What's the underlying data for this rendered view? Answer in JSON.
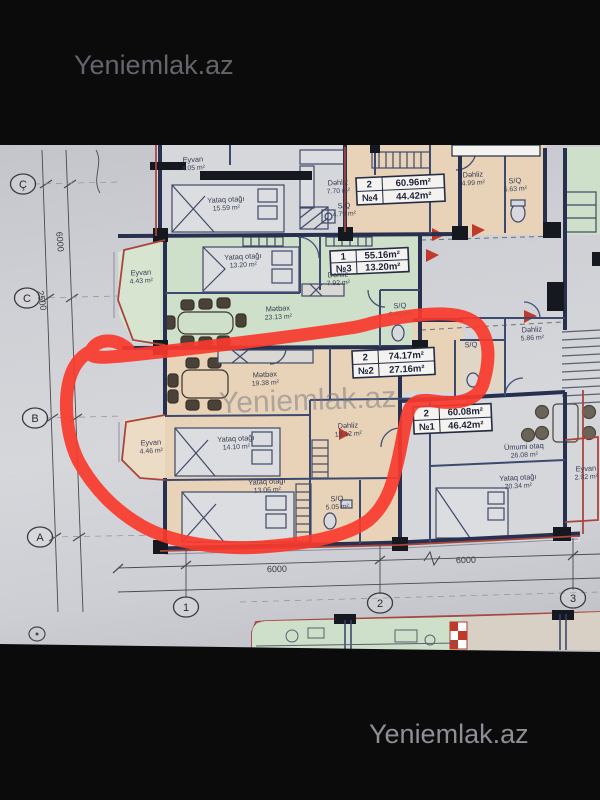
{
  "watermarks": {
    "top": "Yeniemlak.az",
    "middle": "Yeniemlak.az",
    "bottom": "Yeniemlak.az"
  },
  "colors": {
    "marker_red": "#f83a2c",
    "paper": "#d2d3d8",
    "green_unit": "#cfe0ca",
    "green_balcony": "#d6e4d0",
    "tan_unit": "#e8d3b9",
    "tan_balcony": "#ecdbc5",
    "white_unit": "#d6d7db",
    "wall_dark": "#27304e",
    "wall_red": "#a8463e",
    "table_bg": "#f4f3f0",
    "ink": "#353c52"
  },
  "plan": {
    "room_labels": [
      {
        "name": "Eyvan",
        "area": "4.05 m²",
        "x": 193,
        "y": 162
      },
      {
        "name": "Yataq otağı",
        "area": "15.59 m²",
        "x": 226,
        "y": 202
      },
      {
        "name": "Dəhliz",
        "area": "7.70 m²",
        "x": 338,
        "y": 185
      },
      {
        "name": "S/Q",
        "area": "4.79 m²",
        "x": 344,
        "y": 208
      },
      {
        "name": "Dəhliz",
        "area": "4.99 m²",
        "x": 473,
        "y": 177
      },
      {
        "name": "S/Q",
        "area": "5.63 m²",
        "x": 515,
        "y": 183
      },
      {
        "name": "Eyvan",
        "area": "4.43 m²",
        "x": 141,
        "y": 275
      },
      {
        "name": "Yataq otağı",
        "area": "13.20 m²",
        "x": 243,
        "y": 259
      },
      {
        "name": "Dəhliz",
        "area": "7.92 m²",
        "x": 338,
        "y": 277
      },
      {
        "name": "Mətbəx",
        "area": "23.13 m²",
        "x": 278,
        "y": 311
      },
      {
        "name": "S/Q",
        "area": "6.48 m²",
        "x": 400,
        "y": 308
      },
      {
        "name": "Mətbəx",
        "area": "19.38 m²",
        "x": 265,
        "y": 377
      },
      {
        "name": "Dəhliz",
        "area": "18.12 m²",
        "x": 348,
        "y": 428
      },
      {
        "name": "Eyvan",
        "area": "4.46 m²",
        "x": 151,
        "y": 445
      },
      {
        "name": "Yataq otağı",
        "area": "14.10 m²",
        "x": 236,
        "y": 441
      },
      {
        "name": "Yataq otağı",
        "area": "13.06 m²",
        "x": 267,
        "y": 484
      },
      {
        "name": "S/Q",
        "area": "5.05 m²",
        "x": 337,
        "y": 501
      },
      {
        "name": "Dəhliz",
        "area": "5.86 m²",
        "x": 532,
        "y": 332
      },
      {
        "name": "S/Q",
        "area": "",
        "x": 471,
        "y": 347
      },
      {
        "name": "Ümumi otaq",
        "area": "26.08 m²",
        "x": 524,
        "y": 449
      },
      {
        "name": "Yataq otağı",
        "area": "20.34 m²",
        "x": 518,
        "y": 480
      },
      {
        "name": "Eyvan",
        "area": "2.92 m²",
        "x": 586,
        "y": 471
      }
    ],
    "unit_tables": [
      {
        "id": "unit-4",
        "x": 356,
        "y": 178,
        "w": 88,
        "h": 27,
        "rows": [
          [
            "2",
            "60.96m²"
          ],
          [
            "№4",
            "44.42m²"
          ]
        ]
      },
      {
        "id": "unit-3",
        "x": 330,
        "y": 251,
        "w": 78,
        "h": 24,
        "rows": [
          [
            "1",
            "55.16m²"
          ],
          [
            "№3",
            "13.20m²"
          ]
        ]
      },
      {
        "id": "unit-2",
        "x": 352,
        "y": 351,
        "w": 82,
        "h": 27,
        "rows": [
          [
            "2",
            "74.17m²"
          ],
          [
            "№2",
            "27.16m²"
          ]
        ]
      },
      {
        "id": "unit-1",
        "x": 413,
        "y": 407,
        "w": 78,
        "h": 27,
        "rows": [
          [
            "2",
            "60.08m²"
          ],
          [
            "№1",
            "46.42m²"
          ]
        ]
      }
    ],
    "grid_rows": [
      {
        "label": "Ç",
        "x": 23,
        "y": 184
      },
      {
        "label": "C",
        "x": 27,
        "y": 298
      },
      {
        "label": "B",
        "x": 35,
        "y": 418
      },
      {
        "label": "A",
        "x": 40,
        "y": 537
      }
    ],
    "grid_cols": [
      {
        "label": "1",
        "x": 186,
        "y": 607
      },
      {
        "label": "2",
        "x": 380,
        "y": 603
      },
      {
        "label": "3",
        "x": 573,
        "y": 598
      }
    ],
    "dimensions": [
      {
        "text": "6000",
        "x": 277,
        "y": 572,
        "rot": -1.5
      },
      {
        "text": "6000",
        "x": 466,
        "y": 563,
        "rot": -1.5
      },
      {
        "text": "6000",
        "x": 57,
        "y": 242,
        "rot": 85
      },
      {
        "text": "2500",
        "x": 39,
        "y": 301,
        "rot": 80
      }
    ]
  }
}
